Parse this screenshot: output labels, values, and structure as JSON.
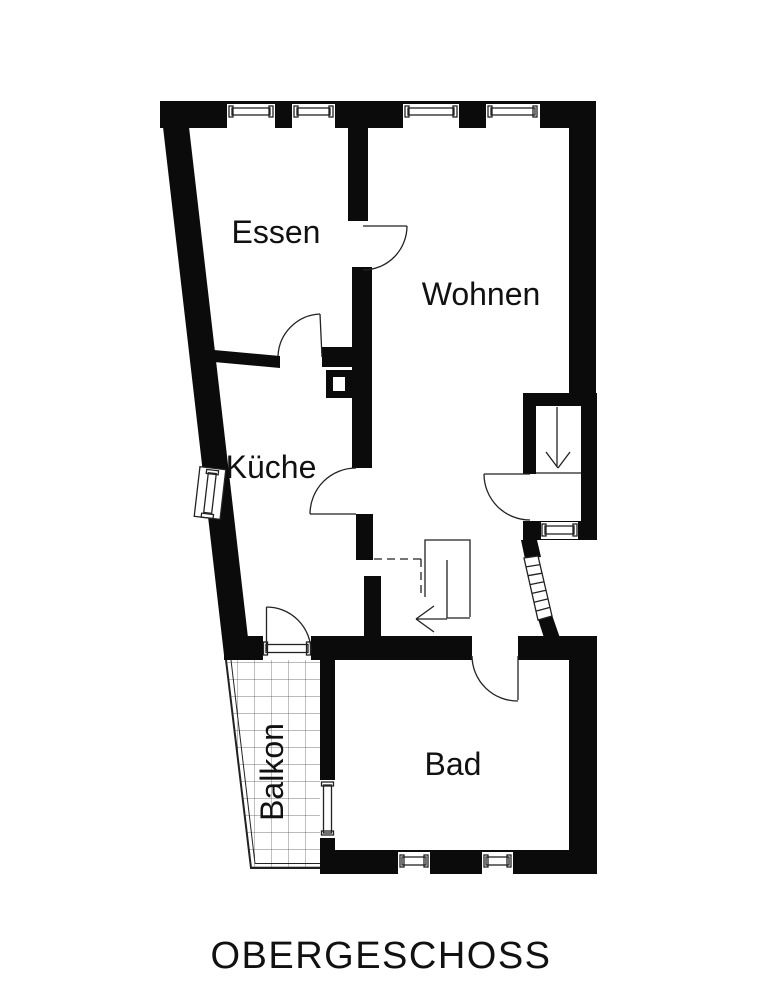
{
  "floorplan": {
    "title": "OBERGESCHOSS",
    "rooms": [
      {
        "id": "essen",
        "label": "Essen"
      },
      {
        "id": "wohnen",
        "label": "Wohnen"
      },
      {
        "id": "kueche",
        "label": "Küche"
      },
      {
        "id": "balkon",
        "label": "Balkon"
      },
      {
        "id": "bad",
        "label": "Bad"
      }
    ],
    "colors": {
      "wall": "#0b0b0b",
      "background": "#ffffff",
      "thin_line": "#222222",
      "hatch_line": "#4a4a4a",
      "text": "#111111"
    }
  }
}
